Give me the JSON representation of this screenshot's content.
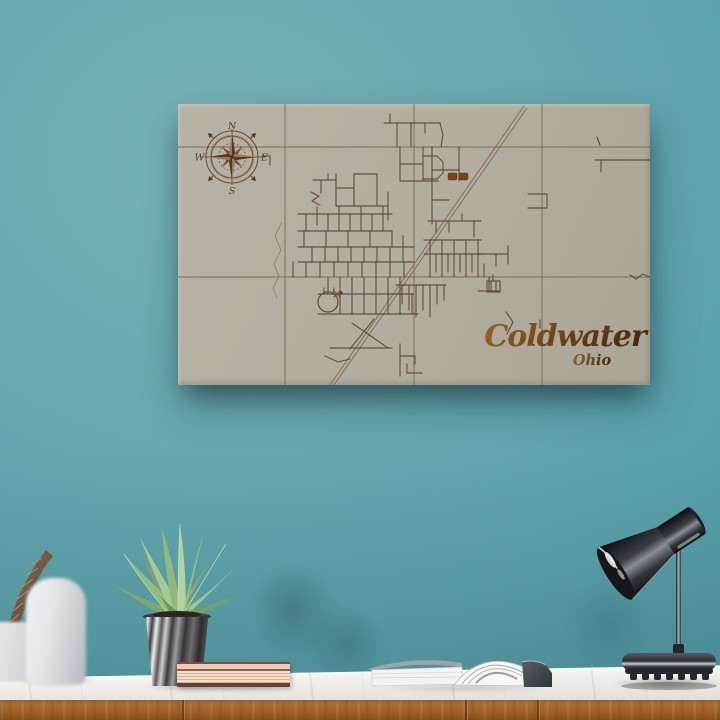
{
  "colors": {
    "wall_teal": "#5ba2ab",
    "wall_light": "#76b1b7",
    "wall_dark": "#4b919b",
    "canvas_beige": "#b2ac9f",
    "street_brown": "#5c4936",
    "grid_brown": "#6f5a42",
    "rail_brown": "#80684c",
    "accent_burn": "#7a4418",
    "title_light": "#94652c",
    "title_dark": "#49290e",
    "compass_dark": "#4f3a22",
    "compass_light": "#9a7a4e",
    "marble_white": "#f1efec",
    "wood_oak": "#a9682d",
    "pot_charcoal": "#3a3a3c",
    "leaf_green": "#9ac284",
    "lamp_gunmetal": "#2e3237"
  },
  "map": {
    "title": "Coldwater",
    "subtitle": "Ohio",
    "compass": {
      "north": "N",
      "east": "E",
      "south": "S",
      "west": "W"
    },
    "grid_roads": [
      [
        [
          107,
          0
        ],
        [
          107,
          281
        ]
      ],
      [
        [
          236,
          0
        ],
        [
          236,
          281
        ]
      ],
      [
        [
          364,
          0
        ],
        [
          364,
          281
        ]
      ],
      [
        [
          0,
          43
        ],
        [
          472,
          43
        ]
      ],
      [
        [
          0,
          173
        ],
        [
          472,
          173
        ]
      ]
    ],
    "railroad": [
      [
        [
          346,
          2
        ],
        [
          152,
          281
        ]
      ],
      [
        [
          349,
          4
        ],
        [
          156,
          281
        ]
      ]
    ],
    "creek": [
      [
        104,
        118
      ],
      [
        97,
        132
      ],
      [
        103,
        146
      ],
      [
        96,
        160
      ],
      [
        101,
        172
      ],
      [
        95,
        184
      ],
      [
        99,
        194
      ]
    ],
    "streets": [
      [
        [
          212,
          10
        ],
        [
          212,
          19
        ]
      ],
      [
        [
          206,
          19
        ],
        [
          262,
          19
        ]
      ],
      [
        [
          219,
          19
        ],
        [
          219,
          43
        ]
      ],
      [
        [
          233,
          19
        ],
        [
          233,
          43
        ]
      ],
      [
        [
          247,
          19
        ],
        [
          247,
          29
        ]
      ],
      [
        [
          262,
          19
        ],
        [
          265,
          31
        ],
        [
          263,
          43
        ]
      ],
      [
        [
          419,
          33
        ],
        [
          422,
          41
        ]
      ],
      [
        [
          417,
          56
        ],
        [
          472,
          56
        ]
      ],
      [
        [
          423,
          56
        ],
        [
          423,
          68
        ]
      ],
      [
        [
          222,
          43
        ],
        [
          222,
          77
        ]
      ],
      [
        [
          245,
          43
        ],
        [
          245,
          77
        ]
      ],
      [
        [
          222,
          60
        ],
        [
          245,
          60
        ]
      ],
      [
        [
          245,
          52
        ],
        [
          259,
          52
        ],
        [
          265,
          58
        ],
        [
          265,
          69
        ],
        [
          259,
          75
        ],
        [
          245,
          75
        ]
      ],
      [
        [
          222,
          77
        ],
        [
          260,
          77
        ]
      ],
      [
        [
          254,
          43
        ],
        [
          254,
          120
        ]
      ],
      [
        [
          281,
          43
        ],
        [
          281,
          77
        ]
      ],
      [
        [
          254,
          66
        ],
        [
          281,
          66
        ]
      ],
      [
        [
          254,
          96
        ],
        [
          271,
          96
        ]
      ],
      [
        [
          250,
          117
        ],
        [
          303,
          117
        ]
      ],
      [
        [
          258,
          117
        ],
        [
          258,
          128
        ]
      ],
      [
        [
          271,
          117
        ],
        [
          271,
          128
        ]
      ],
      [
        [
          284,
          110
        ],
        [
          284,
          117
        ]
      ],
      [
        [
          296,
          117
        ],
        [
          296,
          133
        ]
      ],
      [
        [
          135,
          76
        ],
        [
          158,
          76
        ]
      ],
      [
        [
          143,
          76
        ],
        [
          143,
          89
        ]
      ],
      [
        [
          150,
          70
        ],
        [
          150,
          76
        ]
      ],
      [
        [
          133,
          88
        ],
        [
          141,
          92
        ],
        [
          134,
          97
        ],
        [
          142,
          101
        ]
      ],
      [
        [
          158,
          70
        ],
        [
          158,
          102
        ]
      ],
      [
        [
          158,
          84
        ],
        [
          176,
          84
        ]
      ],
      [
        [
          176,
          70
        ],
        [
          176,
          102
        ]
      ],
      [
        [
          158,
          102
        ],
        [
          210,
          102
        ]
      ],
      [
        [
          199,
          70
        ],
        [
          199,
          102
        ]
      ],
      [
        [
          176,
          70
        ],
        [
          199,
          70
        ]
      ],
      [
        [
          210,
          88
        ],
        [
          210,
          116
        ]
      ],
      [
        [
          84,
          52
        ],
        [
          92,
          52
        ],
        [
          92,
          61
        ]
      ],
      [
        [
          120,
          110
        ],
        [
          214,
          110
        ]
      ],
      [
        [
          128,
          110
        ],
        [
          128,
          127
        ]
      ],
      [
        [
          139,
          103
        ],
        [
          139,
          121
        ]
      ],
      [
        [
          150,
          110
        ],
        [
          150,
          127
        ]
      ],
      [
        [
          161,
          103
        ],
        [
          161,
          127
        ]
      ],
      [
        [
          172,
          110
        ],
        [
          172,
          127
        ]
      ],
      [
        [
          183,
          103
        ],
        [
          183,
          127
        ]
      ],
      [
        [
          194,
          110
        ],
        [
          194,
          127
        ]
      ],
      [
        [
          205,
          103
        ],
        [
          205,
          127
        ]
      ],
      [
        [
          120,
          127
        ],
        [
          214,
          127
        ]
      ],
      [
        [
          120,
          143
        ],
        [
          236,
          143
        ]
      ],
      [
        [
          126,
          127
        ],
        [
          126,
          143
        ]
      ],
      [
        [
          148,
          127
        ],
        [
          148,
          143
        ]
      ],
      [
        [
          170,
          127
        ],
        [
          170,
          143
        ]
      ],
      [
        [
          192,
          127
        ],
        [
          192,
          143
        ]
      ],
      [
        [
          214,
          127
        ],
        [
          214,
          143
        ]
      ],
      [
        [
          225,
          132
        ],
        [
          225,
          143
        ]
      ],
      [
        [
          120,
          158
        ],
        [
          236,
          158
        ]
      ],
      [
        [
          134,
          143
        ],
        [
          134,
          158
        ]
      ],
      [
        [
          147,
          143
        ],
        [
          147,
          158
        ]
      ],
      [
        [
          160,
          143
        ],
        [
          160,
          158
        ]
      ],
      [
        [
          173,
          143
        ],
        [
          173,
          158
        ]
      ],
      [
        [
          186,
          143
        ],
        [
          186,
          158
        ]
      ],
      [
        [
          199,
          143
        ],
        [
          199,
          158
        ]
      ],
      [
        [
          212,
          143
        ],
        [
          212,
          158
        ]
      ],
      [
        [
          225,
          143
        ],
        [
          225,
          158
        ]
      ],
      [
        [
          115,
          158
        ],
        [
          115,
          173
        ]
      ],
      [
        [
          128,
          158
        ],
        [
          128,
          173
        ]
      ],
      [
        [
          142,
          158
        ],
        [
          142,
          173
        ]
      ],
      [
        [
          156,
          158
        ],
        [
          156,
          173
        ]
      ],
      [
        [
          170,
          158
        ],
        [
          170,
          173
        ]
      ],
      [
        [
          184,
          158
        ],
        [
          184,
          173
        ]
      ],
      [
        [
          198,
          158
        ],
        [
          198,
          173
        ]
      ],
      [
        [
          212,
          158
        ],
        [
          212,
          173
        ]
      ],
      [
        [
          226,
          158
        ],
        [
          226,
          173
        ]
      ],
      [
        [
          246,
          150
        ],
        [
          303,
          150
        ]
      ],
      [
        [
          252,
          150
        ],
        [
          252,
          173
        ]
      ],
      [
        [
          258,
          150
        ],
        [
          258,
          168
        ]
      ],
      [
        [
          264,
          150
        ],
        [
          264,
          173
        ]
      ],
      [
        [
          270,
          150
        ],
        [
          270,
          168
        ]
      ],
      [
        [
          276,
          150
        ],
        [
          276,
          173
        ]
      ],
      [
        [
          282,
          150
        ],
        [
          282,
          168
        ]
      ],
      [
        [
          288,
          150
        ],
        [
          288,
          173
        ]
      ],
      [
        [
          294,
          150
        ],
        [
          294,
          168
        ]
      ],
      [
        [
          300,
          150
        ],
        [
          300,
          173
        ]
      ],
      [
        [
          246,
          136
        ],
        [
          303,
          136
        ]
      ],
      [
        [
          252,
          136
        ],
        [
          252,
          150
        ]
      ],
      [
        [
          264,
          136
        ],
        [
          264,
          150
        ]
      ],
      [
        [
          276,
          136
        ],
        [
          276,
          150
        ]
      ],
      [
        [
          288,
          136
        ],
        [
          288,
          150
        ]
      ],
      [
        [
          300,
          136
        ],
        [
          300,
          150
        ]
      ],
      [
        [
          300,
          150
        ],
        [
          330,
          150
        ]
      ],
      [
        [
          330,
          142
        ],
        [
          330,
          160
        ]
      ],
      [
        [
          306,
          160
        ],
        [
          306,
          173
        ]
      ],
      [
        [
          318,
          150
        ],
        [
          318,
          162
        ]
      ],
      [
        [
          140,
          190
        ],
        [
          236,
          190
        ]
      ],
      [
        [
          140,
          210
        ],
        [
          240,
          210
        ]
      ],
      [
        [
          150,
          173
        ],
        [
          150,
          190
        ]
      ],
      [
        [
          162,
          173
        ],
        [
          162,
          210
        ]
      ],
      [
        [
          174,
          173
        ],
        [
          174,
          210
        ]
      ],
      [
        [
          186,
          173
        ],
        [
          186,
          210
        ]
      ],
      [
        [
          198,
          173
        ],
        [
          198,
          210
        ]
      ],
      [
        [
          210,
          173
        ],
        [
          210,
          210
        ]
      ],
      [
        [
          222,
          173
        ],
        [
          222,
          210
        ]
      ],
      [
        [
          234,
          190
        ],
        [
          234,
          210
        ]
      ],
      [
        [
          218,
          181
        ],
        [
          268,
          181
        ]
      ],
      [
        [
          224,
          181
        ],
        [
          224,
          200
        ]
      ],
      [
        [
          231,
          181
        ],
        [
          231,
          206
        ]
      ],
      [
        [
          238,
          181
        ],
        [
          238,
          213
        ]
      ],
      [
        [
          245,
          181
        ],
        [
          245,
          206
        ]
      ],
      [
        [
          252,
          181
        ],
        [
          252,
          213
        ]
      ],
      [
        [
          259,
          181
        ],
        [
          259,
          200
        ]
      ],
      [
        [
          266,
          181
        ],
        [
          266,
          196
        ]
      ],
      [
        [
          300,
          187
        ],
        [
          322,
          187
        ]
      ],
      [
        [
          311,
          173
        ],
        [
          311,
          187
        ]
      ],
      [
        [
          222,
          240
        ],
        [
          222,
          272
        ]
      ],
      [
        [
          222,
          252
        ],
        [
          237,
          252
        ],
        [
          237,
          260
        ]
      ],
      [
        [
          229,
          260
        ],
        [
          229,
          269
        ],
        [
          244,
          269
        ]
      ],
      [
        [
          174,
          219
        ],
        [
          210,
          244
        ]
      ],
      [
        [
          196,
          215
        ],
        [
          172,
          245
        ]
      ],
      [
        [
          152,
          244
        ],
        [
          214,
          244
        ]
      ],
      [
        [
          147,
          252
        ],
        [
          160,
          258
        ],
        [
          172,
          255
        ]
      ],
      [
        [
          350,
          90
        ],
        [
          369,
          90
        ],
        [
          369,
          104
        ],
        [
          350,
          104
        ]
      ],
      [
        [
          452,
          171
        ],
        [
          458,
          175
        ],
        [
          465,
          170
        ],
        [
          472,
          173
        ]
      ],
      [
        [
          362,
          216
        ],
        [
          362,
          224
        ]
      ],
      [
        [
          328,
          208
        ],
        [
          335,
          218
        ],
        [
          329,
          230
        ]
      ],
      [
        [
          156,
          187
        ],
        [
          162,
          193
        ]
      ],
      [
        [
          162,
          187
        ],
        [
          156,
          193
        ]
      ]
    ],
    "pond": {
      "cx": 150,
      "cy": 198,
      "r": 10
    },
    "markers": {
      "buildings": [
        {
          "x": 270,
          "y": 69,
          "w": 9,
          "h": 7
        },
        {
          "x": 281,
          "y": 69,
          "w": 9,
          "h": 7
        }
      ],
      "church": {
        "x": 309,
        "y": 177,
        "w": 13,
        "h": 11
      },
      "dots": [
        {
          "x": 163,
          "y": 189,
          "r": 1.6
        }
      ]
    }
  }
}
